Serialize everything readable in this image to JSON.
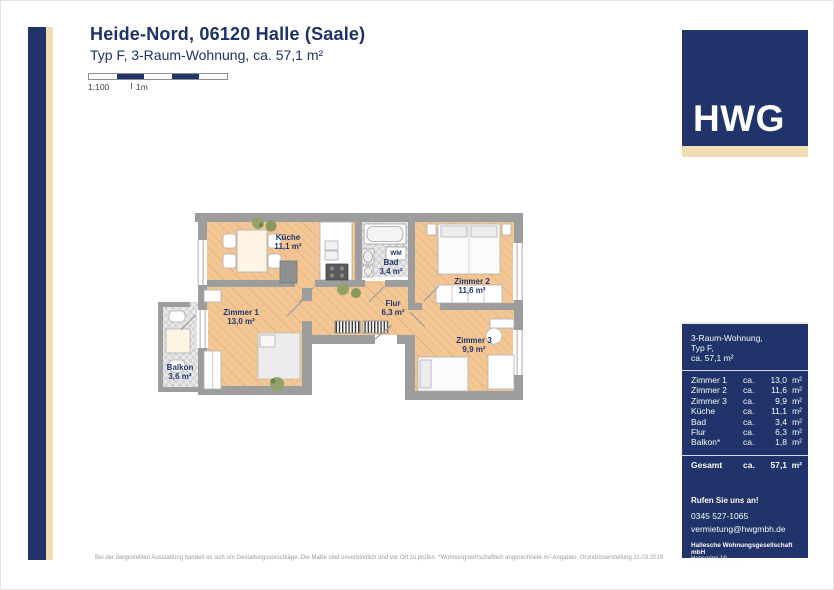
{
  "header": {
    "title": "Heide-Nord, 06120 Halle (Saale)",
    "subtitle": "Typ F, 3-Raum-Wohnung, ca. 57,1 m²"
  },
  "scalebar": {
    "scale": "1:100",
    "unit": "1m"
  },
  "floorplan": {
    "wm_label": "WM",
    "rooms": [
      {
        "name": "Küche",
        "area": "11,1 m²"
      },
      {
        "name": "Bad",
        "area": "3,4 m²"
      },
      {
        "name": "Zimmer 2",
        "area": "11,6 m²"
      },
      {
        "name": "Zimmer 1",
        "area": "13,0 m²"
      },
      {
        "name": "Flur",
        "area": "6,3 m²"
      },
      {
        "name": "Zimmer 3",
        "area": "9,9 m²"
      },
      {
        "name": "Balkon",
        "area": "3,6 m²"
      }
    ]
  },
  "sidebar": {
    "logo": "HWG",
    "summary": {
      "line1": "3-Raum-Wohnung,",
      "line2": "Typ F,",
      "line3": "ca. 57,1 m²"
    },
    "table": {
      "rows": [
        {
          "label": "Zimmer 1",
          "ca": "ca.",
          "value": "13,0",
          "unit": "m²"
        },
        {
          "label": "Zimmer 2",
          "ca": "ca.",
          "value": "11,6",
          "unit": "m²"
        },
        {
          "label": "Zimmer 3",
          "ca": "ca.",
          "value": "9,9",
          "unit": "m²"
        },
        {
          "label": "Küche",
          "ca": "ca.",
          "value": "11,1",
          "unit": "m²"
        },
        {
          "label": "Bad",
          "ca": "ca.",
          "value": "3,4",
          "unit": "m²"
        },
        {
          "label": "Flur",
          "ca": "ca.",
          "value": "6,3",
          "unit": "m²"
        },
        {
          "label": "Balkon*",
          "ca": "ca.",
          "value": "1,8",
          "unit": "m²"
        }
      ],
      "total": {
        "label": "Gesamt",
        "ca": "ca.",
        "value": "57,1",
        "unit": "m²"
      }
    },
    "contact": {
      "call": "Rufen Sie uns an!",
      "phone": "0345 527-1065",
      "email": "vermietung@hwgmbh.de",
      "company": "Hallesche Wohnungsgesellschaft mbH",
      "address1": "Hansering 19,",
      "address2": "06108 Halle (Saale)"
    }
  },
  "footer": {
    "disclaimer": "Bei der dargestellten Ausstattung handelt es sich um Gestaltungsvorschläge. Die Maße sind unverbindlich und vor Ort zu prüfen. *Wohnungswirtschaftlich angerechnete m²-Angaben. Grundrisserstellung  11.03.2019"
  },
  "colors": {
    "navy": "#20336a",
    "beige": "#f2dcb4",
    "wall_gray": "#9d9d9d",
    "wood_floor": "#f3c795",
    "tile_gray": "#d7d7d7",
    "label_navy": "#21366b"
  }
}
